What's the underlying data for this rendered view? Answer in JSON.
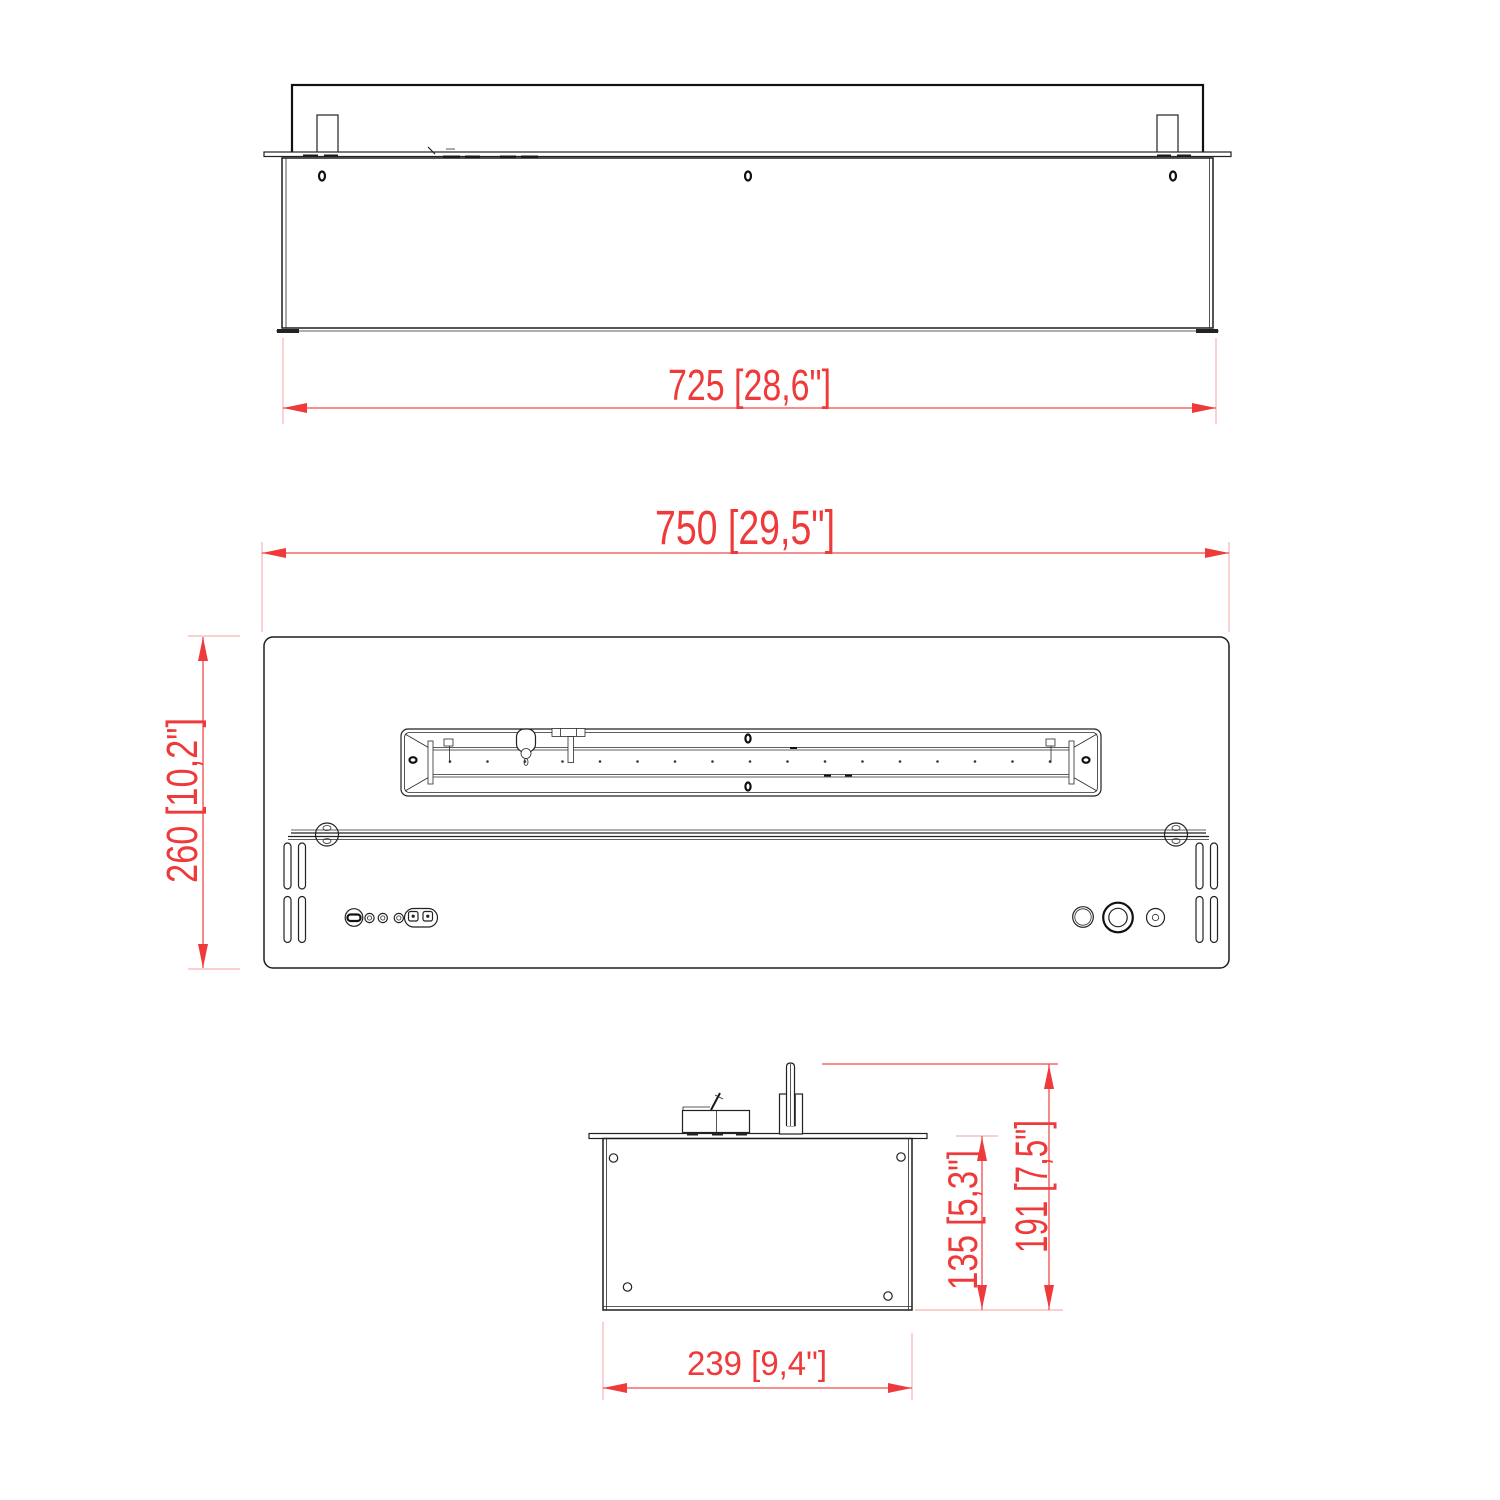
{
  "drawing": {
    "dimensions": {
      "front_width": "725 [28,6\"]",
      "plan_width": "750 [29,5\"]",
      "plan_depth": "260 [10,2\"]",
      "side_width": "239 [9,4\"]",
      "side_inset_height": "135 [5,3\"]",
      "side_total_height": "191 [7,5\"]"
    },
    "colors": {
      "dimension_red": "#ee3a3a",
      "extension_light_red": "#f8b2b2",
      "drawing_line": "#222222",
      "background": "#ffffff"
    }
  }
}
